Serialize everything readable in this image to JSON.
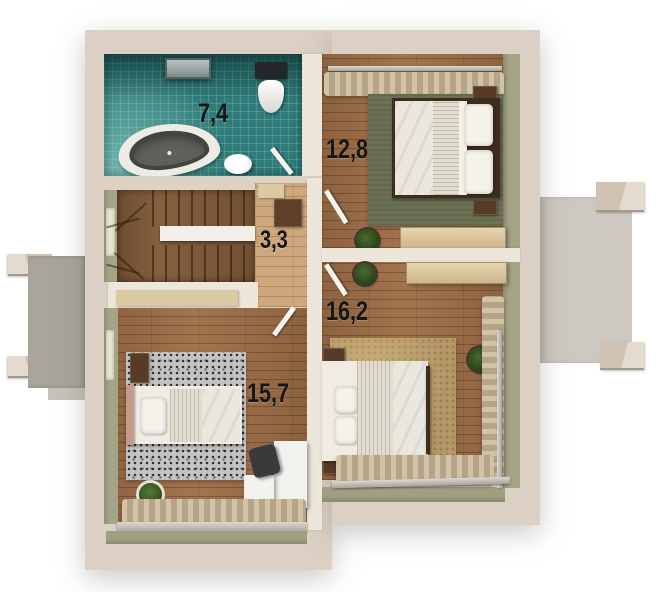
{
  "floor_plan": {
    "type": "upper-floor-plan-3d-render",
    "rooms": [
      {
        "key": "bathroom",
        "area_label": "7,4",
        "fixtures": [
          "bathtub",
          "toilet",
          "sink",
          "ceiling-light",
          "teal-tile-floor",
          "door"
        ]
      },
      {
        "key": "bedroom-top-right",
        "area_label": "12,8",
        "fixtures": [
          "double-bed",
          "pillows",
          "nightstands",
          "green-rug",
          "desk",
          "potted-plant",
          "curtains",
          "door"
        ]
      },
      {
        "key": "stair-hall",
        "area_label": "3,3",
        "fixtures": [
          "u-shaped-staircase",
          "stair-railing",
          "dresser",
          "cabinet"
        ]
      },
      {
        "key": "bedroom-bottom-left",
        "area_label": "15,7",
        "fixtures": [
          "bed",
          "gray-speckled-rug",
          "white-corner-desk",
          "office-chair",
          "potted-plant",
          "nightstand",
          "window-curtains",
          "window-sill"
        ]
      },
      {
        "key": "bedroom-bottom-right",
        "area_label": "16,2",
        "fixtures": [
          "double-bed",
          "pillows",
          "nightstands",
          "tan-rug",
          "desk",
          "potted-plants",
          "window-curtains",
          "window-sill",
          "door"
        ]
      }
    ],
    "exterior": {
      "balconies": [
        "left-balcony",
        "right-balcony"
      ],
      "support_beams": 4
    },
    "palette": {
      "wall_beige": "#dbd0c3",
      "tile_teal": "#2f7c7a",
      "wood_floor": "#9a6e49",
      "hall_wood": "#cda87c",
      "stair_wood": "#85603f",
      "rug_green": "#6a7253",
      "rug_tan": "#b49868",
      "rug_gray": "#c4c3c1",
      "balcony_gray": "#b3aea6",
      "label_color": "#161616"
    }
  }
}
